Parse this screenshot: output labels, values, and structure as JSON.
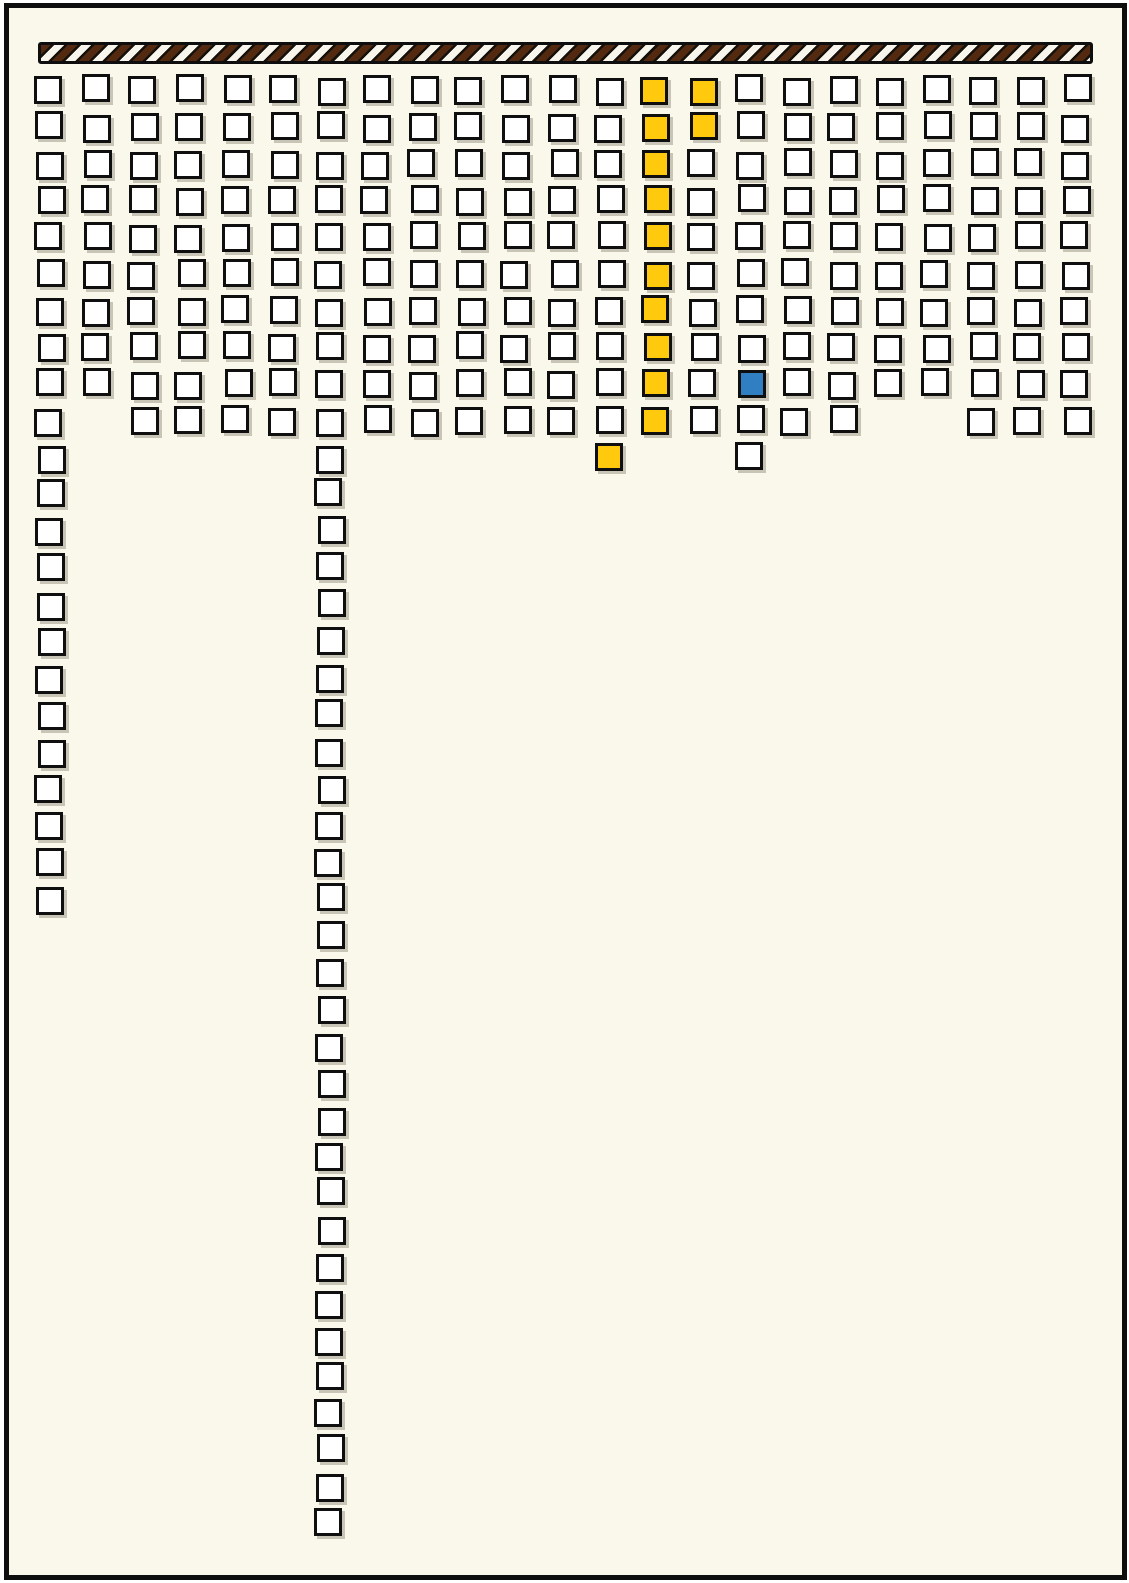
{
  "canvas": {
    "width": 1129,
    "height": 1583,
    "outer_bg": "#ffffff",
    "inner_bg": "#FAF8EB",
    "frame_color": "#0e0e0e"
  },
  "striped_bar": {
    "x": 38,
    "y": 42,
    "width": 1055,
    "height": 22,
    "bar_bg": "#15100a",
    "stripe_dark": "#532a10",
    "stripe_light": "#f8f6ec",
    "border_color": "#0e0e0e"
  },
  "grid": {
    "square_size": 28,
    "x_start": 36,
    "col_spacing": 46.64,
    "y_start": 76,
    "row_spacing": 36.77,
    "border_color": "#0f0f0f",
    "fill_default": "#ffffff",
    "fill_yellow": "#FFC90E",
    "fill_blue": "#2F7FC2",
    "num_columns": 23,
    "column_row_counts": [
      23,
      9,
      10,
      10,
      10,
      10,
      40,
      10,
      10,
      10,
      10,
      10,
      11,
      10,
      10,
      11,
      10,
      10,
      9,
      9,
      10,
      10,
      10
    ],
    "colored_cells": [
      {
        "col": 14,
        "row": 1,
        "color": "yellow"
      },
      {
        "col": 14,
        "row": 2,
        "color": "yellow"
      },
      {
        "col": 14,
        "row": 3,
        "color": "yellow"
      },
      {
        "col": 14,
        "row": 4,
        "color": "yellow"
      },
      {
        "col": 14,
        "row": 5,
        "color": "yellow"
      },
      {
        "col": 14,
        "row": 6,
        "color": "yellow"
      },
      {
        "col": 14,
        "row": 7,
        "color": "yellow"
      },
      {
        "col": 14,
        "row": 8,
        "color": "yellow"
      },
      {
        "col": 14,
        "row": 9,
        "color": "yellow"
      },
      {
        "col": 14,
        "row": 10,
        "color": "yellow"
      },
      {
        "col": 15,
        "row": 1,
        "color": "yellow"
      },
      {
        "col": 15,
        "row": 2,
        "color": "yellow"
      },
      {
        "col": 13,
        "row": 11,
        "color": "yellow"
      },
      {
        "col": 16,
        "row": 9,
        "color": "blue"
      }
    ]
  }
}
